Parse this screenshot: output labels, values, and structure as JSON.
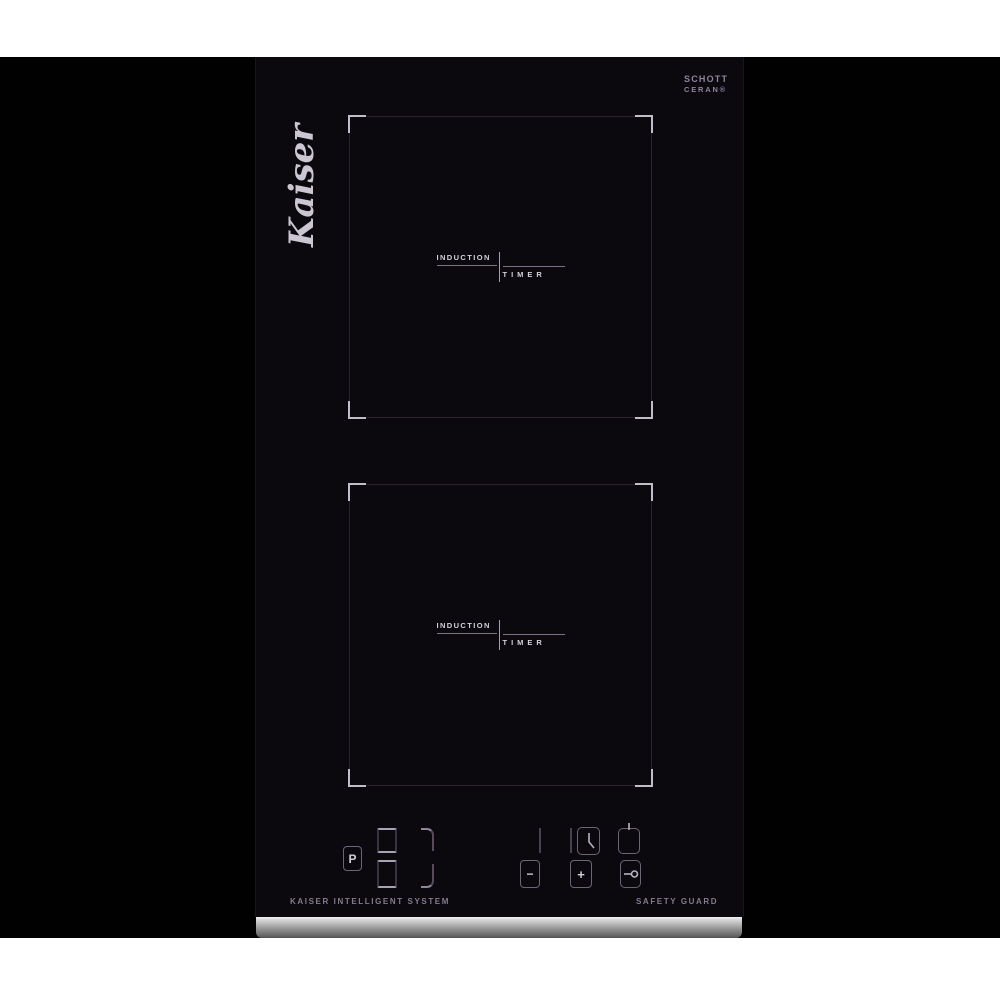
{
  "product": {
    "brand_logo": "Kaiser",
    "glass_brand_line1": "SCHOTT",
    "glass_brand_line2": "CERAN®"
  },
  "zones": [
    {
      "label_primary": "INDUCTION",
      "label_secondary": "TIMER"
    },
    {
      "label_primary": "INDUCTION",
      "label_secondary": "TIMER"
    }
  ],
  "control_panel": {
    "booster_label": "P",
    "minus_label": "−",
    "plus_label": "+",
    "icons": {
      "timer_button": "clock-icon",
      "power_button": "power-icon",
      "lock_button": "key-icon",
      "display": "seven-segment-digit-outline"
    }
  },
  "footer": {
    "left_text": "KAISER INTELLIGENT SYSTEM",
    "right_text": "SAFETY GUARD"
  },
  "colors": {
    "background_margin": "#ffffff",
    "photo_backdrop": "#020102",
    "glass": "#0b080e",
    "zone_outline_dim": "#2c2233",
    "zone_corner_bright": "#c2bccb",
    "label_text": "#d6d0dd",
    "control_border": "#6e6478",
    "footer_text": "#857b90",
    "steel_light": "#f4f4f4",
    "steel_dark": "#535353"
  }
}
